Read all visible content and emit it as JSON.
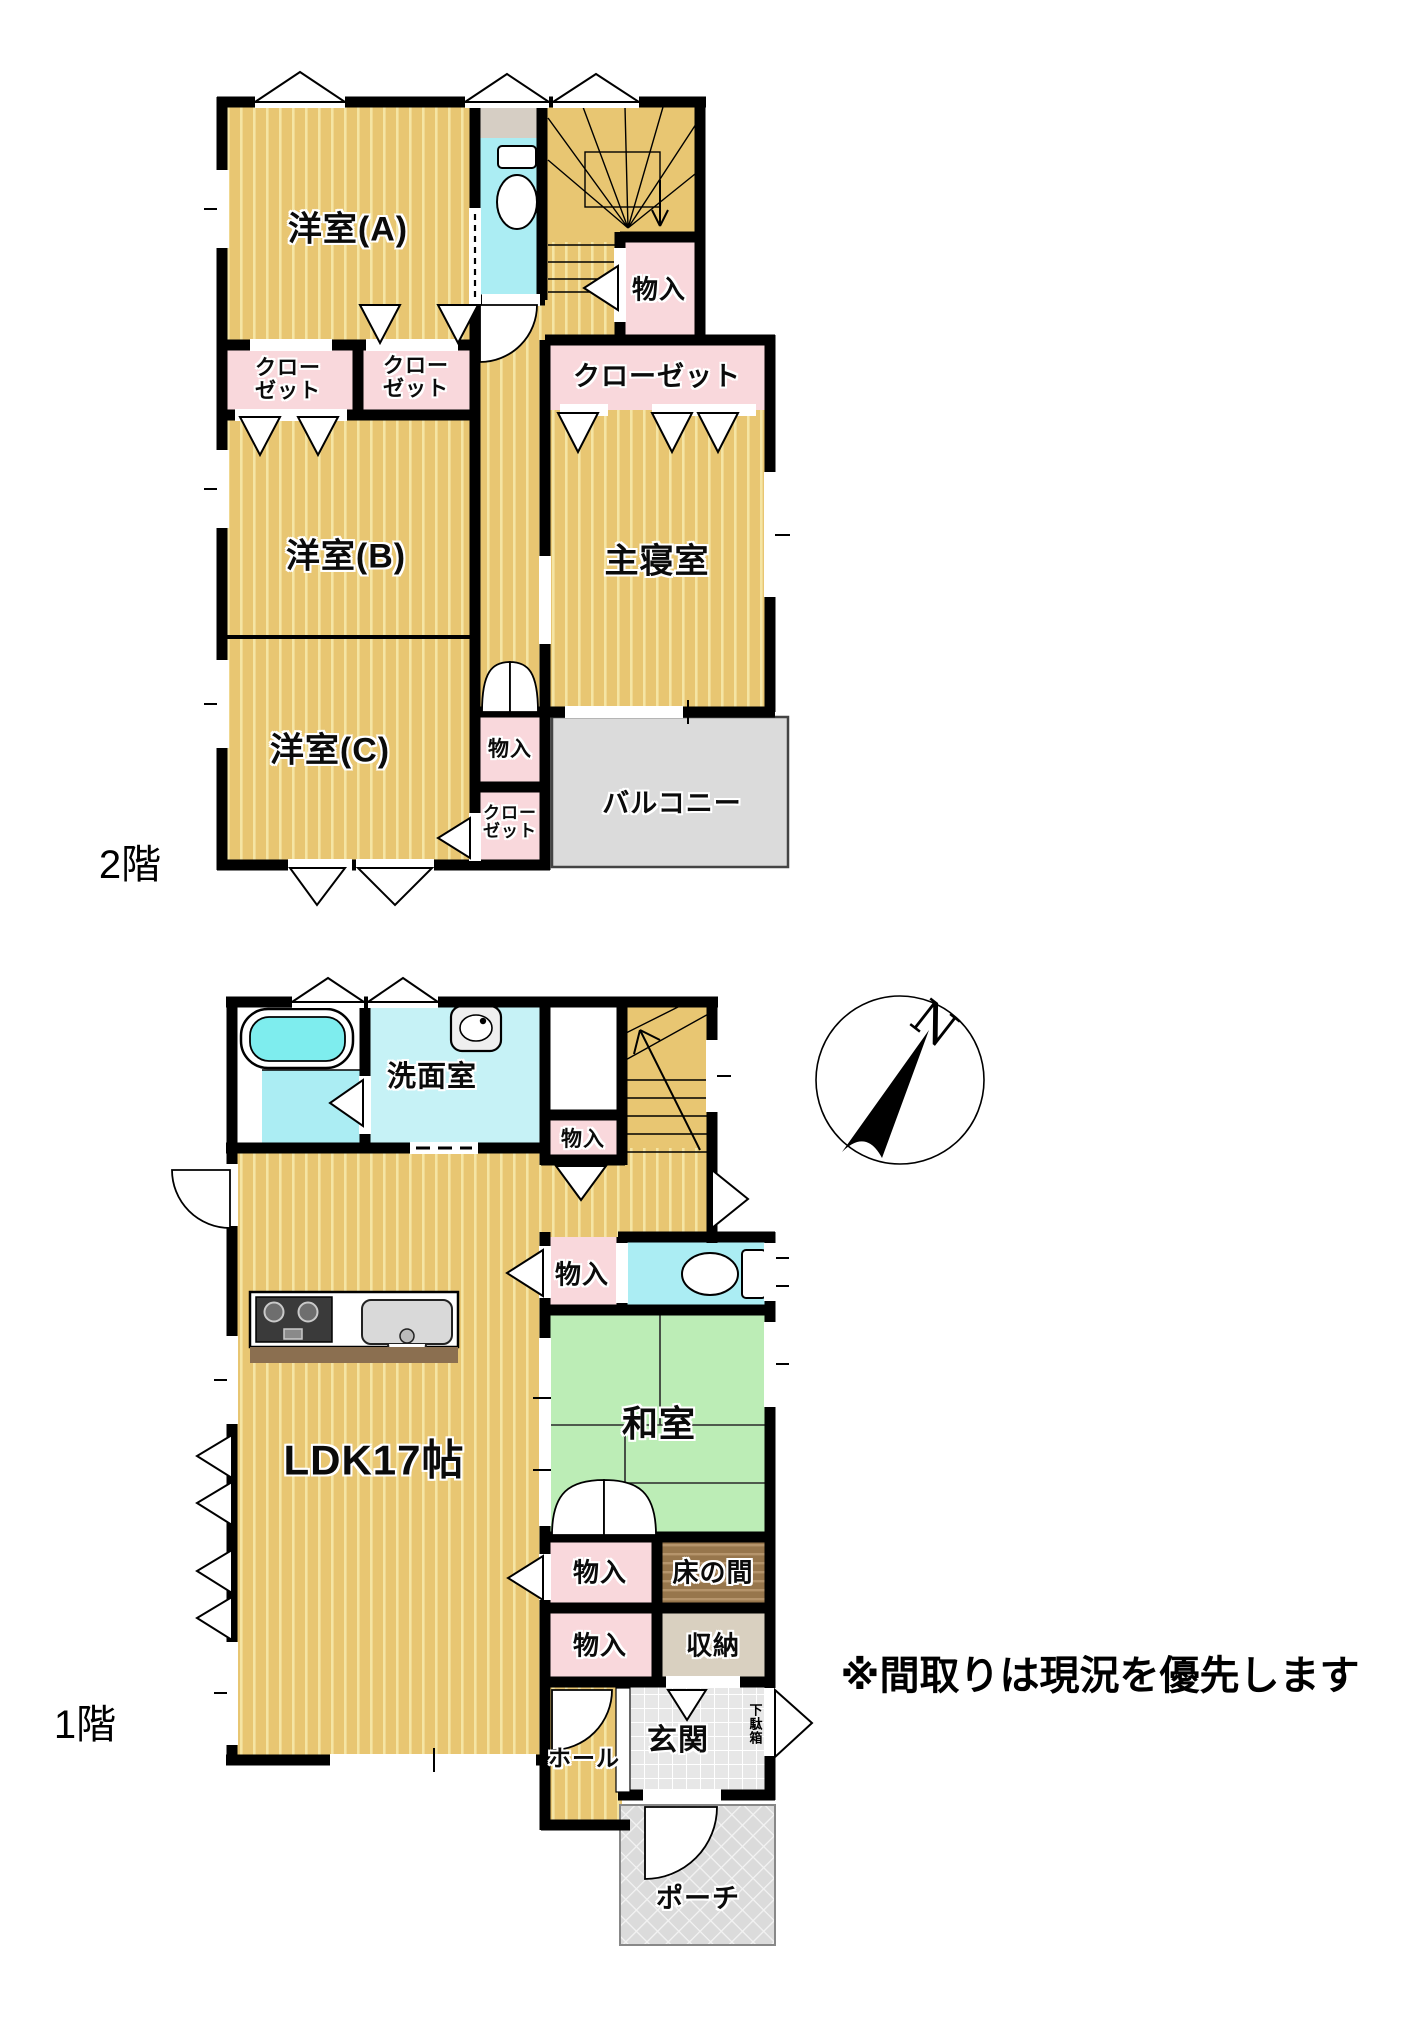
{
  "title": "間取り図",
  "note": "※間取りは現況を優先します",
  "compass": {
    "label": "N"
  },
  "colors": {
    "wood": "#E8C672",
    "wood_stripe": "#F5E5A4",
    "closet_pink": "#F9D8DC",
    "water_cyan": "#ABEDF3",
    "washroom_cyan": "#C6F2F6",
    "tatami_green": "#BCEDB6",
    "balcony_gray": "#DBDBDB",
    "tokonoma_brown": "#97764C",
    "shuno_beige": "#D9D0C0",
    "tile_gray": "#E7E7E7",
    "wall": "#000000",
    "tub_cyan": "#7EEDEE"
  },
  "f2": {
    "label": "2階",
    "yoshitsu_a": "洋室(A)",
    "yoshitsu_b": "洋室(B)",
    "yoshitsu_c": "洋室(C)",
    "closet_l1": "クロー",
    "closet_l2": "ゼット",
    "closet_wide": "クローゼット",
    "monoiri_hall": "物入",
    "monoiri_c": "物入",
    "shushinshitsu": "主寝室",
    "balcony": "バルコニー"
  },
  "f1": {
    "label": "1階",
    "senmen": "洗面室",
    "monoiri_stairs": "物入",
    "monoiri_ldk": "物入",
    "washitsu": "和室",
    "ldk": "LDK17帖",
    "monoiri_1": "物入",
    "tokonoma": "床の間",
    "monoiri_2": "物入",
    "shuno": "収納",
    "genkan": "玄関",
    "getabako": "下駄箱",
    "hall": "ホール",
    "porch": "ポーチ"
  }
}
